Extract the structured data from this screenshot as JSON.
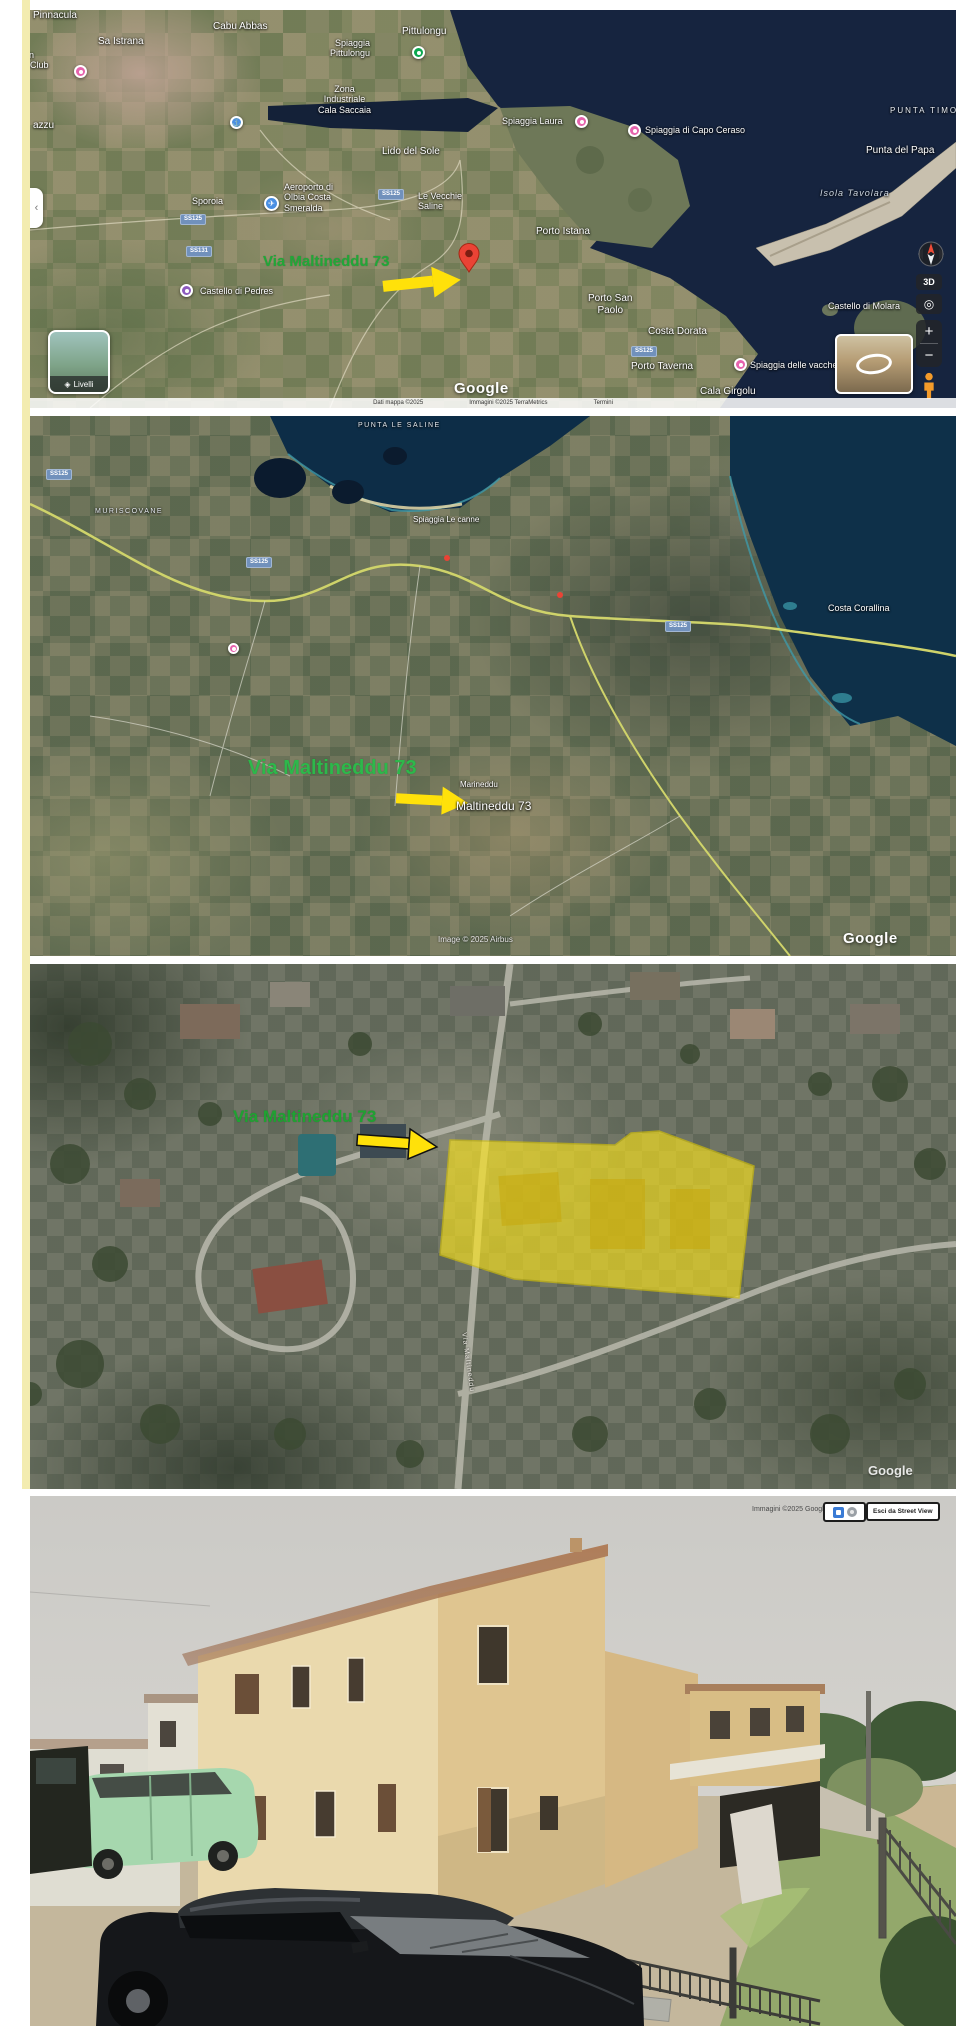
{
  "page": {
    "background": "#ffffff",
    "left_edge_color": "#f3ecb0"
  },
  "colors": {
    "annotation_green": "#21a738",
    "arrow_yellow": "#ffe10a",
    "parcel_yellow": "#ffe719",
    "sea": "#16243f",
    "pin_red": "#ea4335"
  },
  "map1": {
    "attribution": {
      "left": "Dati mappa ©2025",
      "mid": "Immagini ©2025 TerraMetrics",
      "right": "Termini"
    },
    "controls": {
      "side_tab": "‹",
      "layers_icon": "◈",
      "layers_label": "Livelli",
      "btn_3d": "3D",
      "reset_icon": "◎",
      "zoom_in": "+",
      "zoom_out": "−"
    },
    "labels": [
      {
        "name": "label-pinnacula",
        "text": "Pinnacula",
        "cls": "town",
        "style": "left:3px;top:0px",
        "inter": false
      },
      {
        "name": "label-sa-istrana",
        "text": "Sa Istrana",
        "cls": "town",
        "style": "left:68px;top:26px",
        "inter": false
      },
      {
        "name": "label-cabu-abbas",
        "text": "Cabu Abbas",
        "cls": "town",
        "style": "left:183px;top:11px",
        "inter": false
      },
      {
        "name": "label-pittulongu",
        "text": "Pittulongu",
        "cls": "town",
        "style": "left:372px;top:16px",
        "inter": false
      },
      {
        "name": "label-spiaggia-pittulongu",
        "text": "Spiaggia\nPittulongu",
        "cls": "poi rgt",
        "style": "left:300px;top:28px",
        "inter": false
      },
      {
        "name": "pin-spiaggia-pittulongu",
        "text": "",
        "cls": "pin greenpin dot",
        "style": "left:382px;top:36px",
        "inter": true
      },
      {
        "name": "label-country-club",
        "text": "Sardinian\nCountry Club",
        "cls": "poi",
        "style": "left:-34px;top:40px",
        "inter": false
      },
      {
        "name": "pin-country-club",
        "text": "",
        "cls": "pin pink dot",
        "style": "left:44px;top:55px",
        "inter": true
      },
      {
        "name": "label-azzu",
        "text": "azzu",
        "cls": "town",
        "style": "left:3px;top:110px",
        "inter": false
      },
      {
        "name": "pin-port",
        "text": "⚓",
        "cls": "pin bluepin",
        "style": "left:200px;top:106px",
        "inter": true
      },
      {
        "name": "label-zona-industriale",
        "text": "Zona\nIndustriale\nCala Saccaia",
        "cls": "poi ctr",
        "style": "left:288px;top:74px",
        "inter": false
      },
      {
        "name": "label-lido-del-sole",
        "text": "Lido del Sole",
        "cls": "town",
        "style": "left:352px;top:136px",
        "inter": false
      },
      {
        "name": "label-sporoia",
        "text": "Sporoia",
        "cls": "town-sm",
        "style": "left:162px;top:186px",
        "inter": false
      },
      {
        "name": "pin-airport",
        "text": "✈",
        "cls": "pin bluepin",
        "style": "left:234px;top:186px;width:15px;height:15px",
        "inter": true
      },
      {
        "name": "label-airport",
        "text": "Aeroporto di\nOlbia Costa\nSmeralda",
        "cls": "poi",
        "style": "left:254px;top:172px",
        "inter": false
      },
      {
        "name": "label-le-vecchie-saline",
        "text": "Le Vecchie\nSaline",
        "cls": "poi",
        "style": "left:388px;top:181px",
        "inter": false
      },
      {
        "name": "shield-ss125-a",
        "text": "SS125",
        "cls": "shield",
        "style": "left:150px;top:204px",
        "inter": false
      },
      {
        "name": "shield-ss131",
        "text": "SS131",
        "cls": "shield",
        "style": "left:156px;top:236px",
        "inter": false
      },
      {
        "name": "shield-ss125-b",
        "text": "SS125",
        "cls": "shield",
        "style": "left:348px;top:179px",
        "inter": false
      },
      {
        "name": "shield-ss125-c",
        "text": "SS125",
        "cls": "shield",
        "style": "left:601px;top:336px",
        "inter": false
      },
      {
        "name": "annotation-address",
        "text": "Via Maltineddu 73",
        "cls": "green1",
        "style": "left:233px;top:243px",
        "inter": false
      },
      {
        "name": "pin-castello-di-pedres",
        "text": "",
        "cls": "pin purple dot",
        "style": "left:150px;top:274px",
        "inter": true
      },
      {
        "name": "label-castello-di-pedres",
        "text": "Castello di Pedres",
        "cls": "poi",
        "style": "left:170px;top:276px",
        "inter": false
      },
      {
        "name": "label-spiaggia-laura",
        "text": "Spiaggia Laura",
        "cls": "poi",
        "style": "left:472px;top:106px",
        "inter": false
      },
      {
        "name": "pin-spiaggia-laura",
        "text": "",
        "cls": "pin pink dot",
        "style": "left:545px;top:105px",
        "inter": true
      },
      {
        "name": "pin-capo-ceraso",
        "text": "",
        "cls": "pin pink dot",
        "style": "left:598px;top:114px",
        "inter": true
      },
      {
        "name": "label-capo-ceraso",
        "text": "Spiaggia di Capo Ceraso",
        "cls": "poi",
        "style": "left:615px;top:115px",
        "inter": false
      },
      {
        "name": "label-porto-istana",
        "text": "Porto Istana",
        "cls": "town",
        "style": "left:506px;top:216px",
        "inter": false
      },
      {
        "name": "label-punta-timone",
        "text": "PUNTA TIMONE",
        "cls": "cap",
        "style": "left:860px;top:96px",
        "inter": false
      },
      {
        "name": "label-punta-del-papa",
        "text": "Punta del Papa",
        "cls": "town",
        "style": "left:836px;top:135px",
        "inter": false
      },
      {
        "name": "label-isola-tavolara",
        "text": "Isola Tavolara",
        "cls": "sea-it",
        "style": "left:790px;top:178px",
        "inter": false
      },
      {
        "name": "label-porto-san-paolo",
        "text": "Porto San\nPaolo",
        "cls": "town ctr",
        "style": "left:558px;top:283px",
        "inter": false
      },
      {
        "name": "label-costa-dorata",
        "text": "Costa Dorata",
        "cls": "town",
        "style": "left:618px;top:316px",
        "inter": false
      },
      {
        "name": "label-porto-taverna",
        "text": "Porto Taverna",
        "cls": "town",
        "style": "left:601px;top:351px",
        "inter": false
      },
      {
        "name": "pin-spiaggia-delle-vacche",
        "text": "",
        "cls": "pin pink dot",
        "style": "left:704px;top:348px",
        "inter": true
      },
      {
        "name": "label-spiaggia-delle-vacche",
        "text": "Spiaggia delle vacche",
        "cls": "poi",
        "style": "left:720px;top:350px",
        "inter": false
      },
      {
        "name": "label-cala-girgolu",
        "text": "Cala Girgolu",
        "cls": "town",
        "style": "left:670px;top:376px",
        "inter": false
      },
      {
        "name": "label-castello-di-molara",
        "text": "Castello di Molara",
        "cls": "poi",
        "style": "left:798px;top:291px",
        "inter": false
      },
      {
        "name": "google-logo",
        "text": "Google",
        "cls": "glogo",
        "style": "left:424px;top:370px",
        "inter": false
      }
    ]
  },
  "map2": {
    "attribution": "Image © 2025 Airbus",
    "labels": [
      {
        "name": "label-punta-le-saline",
        "text": "PUNTA LE SALINE",
        "cls": "cap-sm",
        "style": "left:328px;top:6px",
        "inter": false
      },
      {
        "name": "label-muriscovane",
        "text": "MURISCOVANE",
        "cls": "cap-sm",
        "style": "left:65px;top:92px",
        "inter": false
      },
      {
        "name": "label-spiaggia-le-canne",
        "text": "Spiaggia Le canne",
        "cls": "poi-sm",
        "style": "left:383px;top:99px",
        "inter": false
      },
      {
        "name": "label-costa-corallina",
        "text": "Costa Corallina",
        "cls": "town-sm",
        "style": "left:798px;top:187px",
        "inter": false
      },
      {
        "name": "shield-ss125-d",
        "text": "SS125",
        "cls": "shield",
        "style": "left:16px;top:53px",
        "inter": false
      },
      {
        "name": "shield-ss125-e",
        "text": "SS125",
        "cls": "shield",
        "style": "left:216px;top:141px",
        "inter": false
      },
      {
        "name": "shield-ss125-f",
        "text": "SS125",
        "cls": "shield",
        "style": "left:635px;top:205px",
        "inter": false
      },
      {
        "name": "pin-via-agostino",
        "text": "",
        "cls": "pin pink dot",
        "style": "left:198px;top:227px;width:11px;height:11px",
        "inter": true
      },
      {
        "name": "annotation-address",
        "text": "Via Maltineddu 73",
        "cls": "green2",
        "style": "left:218px;top:341px",
        "inter": false
      },
      {
        "name": "label-marineddu",
        "text": "Marineddu",
        "cls": "poi-sm",
        "style": "left:430px;top:364px",
        "inter": false
      },
      {
        "name": "label-maltineddu-73",
        "text": "Maltineddu 73",
        "cls": "poi",
        "style": "left:426px;top:384px;font-size:12px",
        "inter": false
      },
      {
        "name": "map-attribution",
        "text": "Image © 2025 Airbus",
        "cls": "attr2",
        "style": "left:408px;top:519px",
        "inter": false
      },
      {
        "name": "google-logo",
        "text": "Google",
        "cls": "glogo",
        "style": "left:813px;top:514px",
        "inter": false
      }
    ]
  },
  "map3": {
    "labels": [
      {
        "name": "annotation-address",
        "text": "Via Maltineddu 73",
        "cls": "green3",
        "style": "left:203px;top:143px",
        "inter": false
      },
      {
        "name": "label-street-via-maltineddu",
        "text": "Via Maltineddu",
        "cls": "street",
        "style": "left:437px;top:368px",
        "inter": false
      },
      {
        "name": "google-logo",
        "text": "Google",
        "cls": "glogo-faint",
        "style": "left:838px;top:500px",
        "inter": false
      }
    ]
  },
  "photo": {
    "attribution": "Immagini ©2025 Google",
    "exit_button": "Esci da Street View"
  }
}
